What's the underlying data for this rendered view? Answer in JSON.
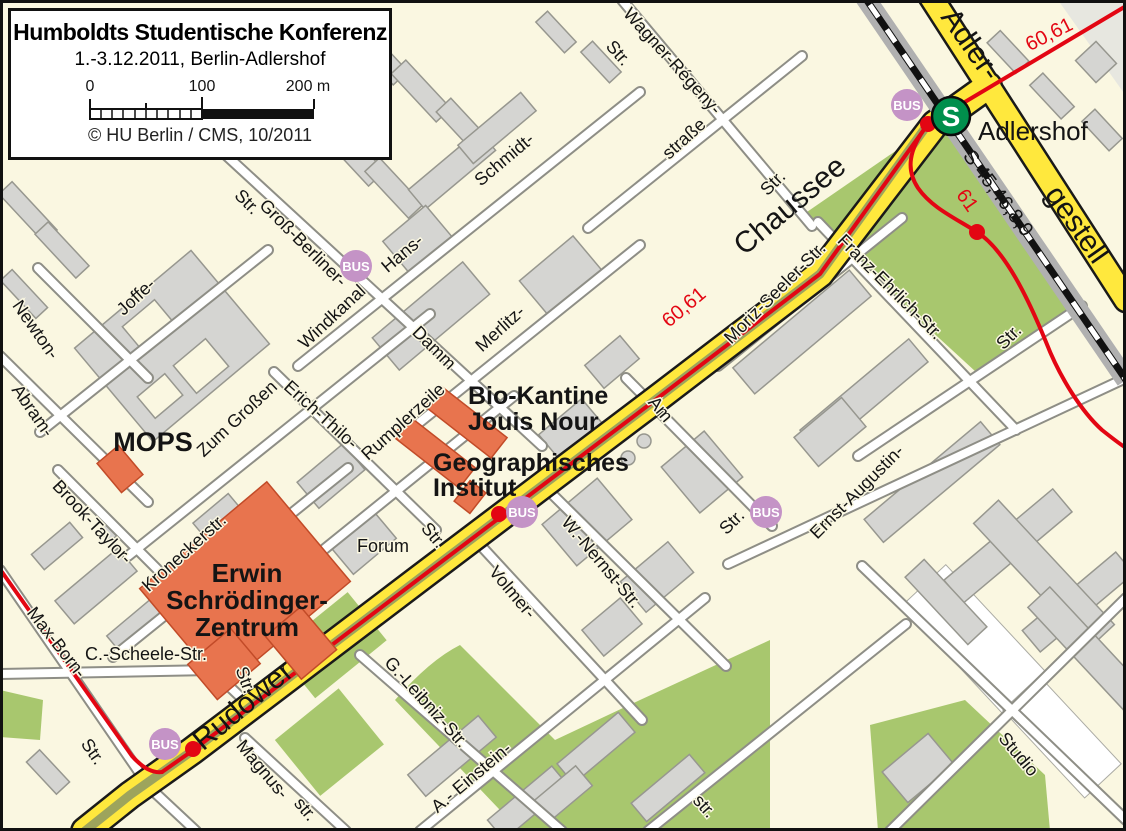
{
  "title_box": {
    "title": "Humboldts Studentische Konferenz",
    "subtitle": "1.-3.12.2011, Berlin-Adlershof",
    "scale_labels": [
      "0",
      "100",
      "200 m"
    ],
    "copyright": "© HU Berlin / CMS, 10/2011"
  },
  "map": {
    "station": {
      "name": "Adlershof",
      "s_symbol": "S"
    },
    "bus_label": "BUS",
    "colors": {
      "background": "#FAF7E1",
      "building_gray": "#D5D5D2",
      "landmark_orange": "#E8744E",
      "park_green": "#A8C76E",
      "road_yellow": "#FFE83D",
      "tram_red": "#E30613",
      "bus_purple": "#C493C6",
      "sbahn_green": "#008F4C"
    },
    "road_labels": [
      {
        "t": "Rudower",
        "x": 249,
        "y": 713,
        "r": -40
      },
      {
        "t": "Chaussee",
        "x": 796,
        "y": 213,
        "r": -40
      },
      {
        "t": "Adler-",
        "x": 963,
        "y": 50,
        "r": 55
      },
      {
        "t": "gestell",
        "x": 1069,
        "y": 230,
        "r": 55
      }
    ],
    "transit_labels": [
      {
        "t": "S 45,46,8,9",
        "x": 993,
        "y": 197,
        "r": 53,
        "kind": "rail"
      },
      {
        "t": "61",
        "x": 962,
        "y": 204,
        "r": 55,
        "kind": "tram"
      },
      {
        "t": "60,61",
        "x": 1052,
        "y": 40,
        "r": -27,
        "kind": "tram"
      },
      {
        "t": "60,61",
        "x": 688,
        "y": 312,
        "r": -40,
        "kind": "tram"
      }
    ],
    "street_labels": [
      {
        "t": "Wagner-Régeny-",
        "x": 668,
        "y": 65,
        "r": 48
      },
      {
        "t": "Str.",
        "x": 614,
        "y": 57,
        "r": 48
      },
      {
        "t": "straße",
        "x": 688,
        "y": 143,
        "r": -42
      },
      {
        "t": "Schmidt-",
        "x": 508,
        "y": 164,
        "r": -40
      },
      {
        "t": "Hans-",
        "x": 406,
        "y": 258,
        "r": -40
      },
      {
        "t": "Str.",
        "x": 777,
        "y": 187,
        "r": -45
      },
      {
        "t": "Str.",
        "x": 243,
        "y": 206,
        "r": 45
      },
      {
        "t": "Groß-Berliner-",
        "x": 299,
        "y": 247,
        "r": 45
      },
      {
        "t": "Damm",
        "x": 430,
        "y": 352,
        "r": 45
      },
      {
        "t": "Windkanal",
        "x": 336,
        "y": 321,
        "r": -43
      },
      {
        "t": "Zum Großen",
        "x": 241,
        "y": 423,
        "r": -43
      },
      {
        "t": "Joffe-",
        "x": 140,
        "y": 301,
        "r": -43
      },
      {
        "t": "Newton-",
        "x": 31,
        "y": 333,
        "r": 55
      },
      {
        "t": "Abram-",
        "x": 28,
        "y": 414,
        "r": 55
      },
      {
        "t": "Merlitz-",
        "x": 504,
        "y": 333,
        "r": -42
      },
      {
        "t": "Erich-Thilo-",
        "x": 317,
        "y": 419,
        "r": 42
      },
      {
        "t": "Rumplerzeile",
        "x": 407,
        "y": 426,
        "r": -42
      },
      {
        "t": "Brook-Taylor-",
        "x": 88,
        "y": 526,
        "r": 47
      },
      {
        "t": "Kroneckerstr.",
        "x": 188,
        "y": 557,
        "r": -42
      },
      {
        "t": "Str.",
        "x": 240,
        "y": 682,
        "r": 70
      },
      {
        "t": "C.-Scheele-Str.",
        "x": 146,
        "y": 660,
        "r": 0
      },
      {
        "t": "Max-Born-",
        "x": 52,
        "y": 646,
        "r": 52
      },
      {
        "t": "Str.",
        "x": 88,
        "y": 755,
        "r": 55
      },
      {
        "t": "Forum",
        "x": 383,
        "y": 552,
        "r": 0
      },
      {
        "t": "Str.",
        "x": 429,
        "y": 539,
        "r": 50
      },
      {
        "t": "Volmer-",
        "x": 508,
        "y": 596,
        "r": 50
      },
      {
        "t": "W.-Nernst-Str.",
        "x": 597,
        "y": 566,
        "r": 50
      },
      {
        "t": "Am",
        "x": 656,
        "y": 413,
        "r": 50
      },
      {
        "t": "Moriz-Seeler-Str.",
        "x": 779,
        "y": 297,
        "r": -45
      },
      {
        "t": "Franz-Ehrlich-Str.",
        "x": 886,
        "y": 291,
        "r": 45
      },
      {
        "t": "Str.",
        "x": 1013,
        "y": 341,
        "r": -45
      },
      {
        "t": "Ernst-Augustin-",
        "x": 861,
        "y": 496,
        "r": -45
      },
      {
        "t": "Str.",
        "x": 736,
        "y": 526,
        "r": -45
      },
      {
        "t": "Magnus-",
        "x": 258,
        "y": 773,
        "r": 50
      },
      {
        "t": "str.",
        "x": 301,
        "y": 813,
        "r": 50
      },
      {
        "t": "G.-Leibniz-Str.",
        "x": 422,
        "y": 706,
        "r": 48
      },
      {
        "t": "A.- Einstein-",
        "x": 475,
        "y": 782,
        "r": -40
      },
      {
        "t": "str.",
        "x": 700,
        "y": 810,
        "r": 48
      },
      {
        "t": "Studio",
        "x": 1014,
        "y": 758,
        "r": 50
      }
    ],
    "landmarks": [
      {
        "lines": [
          "MOPS"
        ],
        "x": 153,
        "y": 451,
        "s": 27,
        "anchor": "middle",
        "lh": 27
      },
      {
        "lines": [
          "Bio-Kantine",
          "Jouis Nour"
        ],
        "x": 468,
        "y": 404,
        "s": 25,
        "anchor": "start",
        "lh": 26
      },
      {
        "lines": [
          "Geographisches",
          "Institut"
        ],
        "x": 433,
        "y": 471,
        "s": 25,
        "anchor": "start",
        "lh": 25
      },
      {
        "lines": [
          "Erwin",
          "Schrödinger-",
          "Zentrum"
        ],
        "x": 247,
        "y": 582,
        "s": 26,
        "anchor": "middle",
        "lh": 27
      }
    ],
    "bus_stops": [
      {
        "x": 356,
        "y": 266
      },
      {
        "x": 522,
        "y": 512
      },
      {
        "x": 766,
        "y": 512
      },
      {
        "x": 907,
        "y": 105
      },
      {
        "x": 165,
        "y": 744
      }
    ]
  }
}
